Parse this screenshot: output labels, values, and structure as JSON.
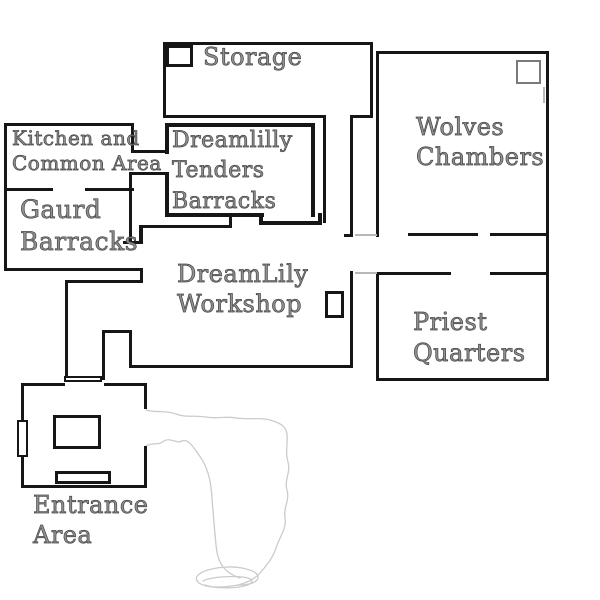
{
  "title": "DreamLily compound floor plan",
  "rooms": {
    "storage": {
      "label": "Storage"
    },
    "wolves_chambers": {
      "label": "Wolves\nChambers"
    },
    "kitchen_common": {
      "label": "Kitchen and\nCommon Area"
    },
    "dreamlilly_tenders_barracks": {
      "label": "Dreamlilly\nTenders\nBarracks"
    },
    "gaurd_barracks": {
      "label": "Gaurd\nBarracks"
    },
    "dreamlily_workshop": {
      "label": "DreamLily\nWorkshop"
    },
    "priest_quarters": {
      "label": "Priest\nQuarters"
    },
    "entrance_area": {
      "label": "Entrance\nArea"
    }
  },
  "colors": {
    "wall": "#161616",
    "label_fill": "#909090",
    "label_stroke": "#454545",
    "sketch_line": "#cbcbcb",
    "background": "#ffffff"
  }
}
